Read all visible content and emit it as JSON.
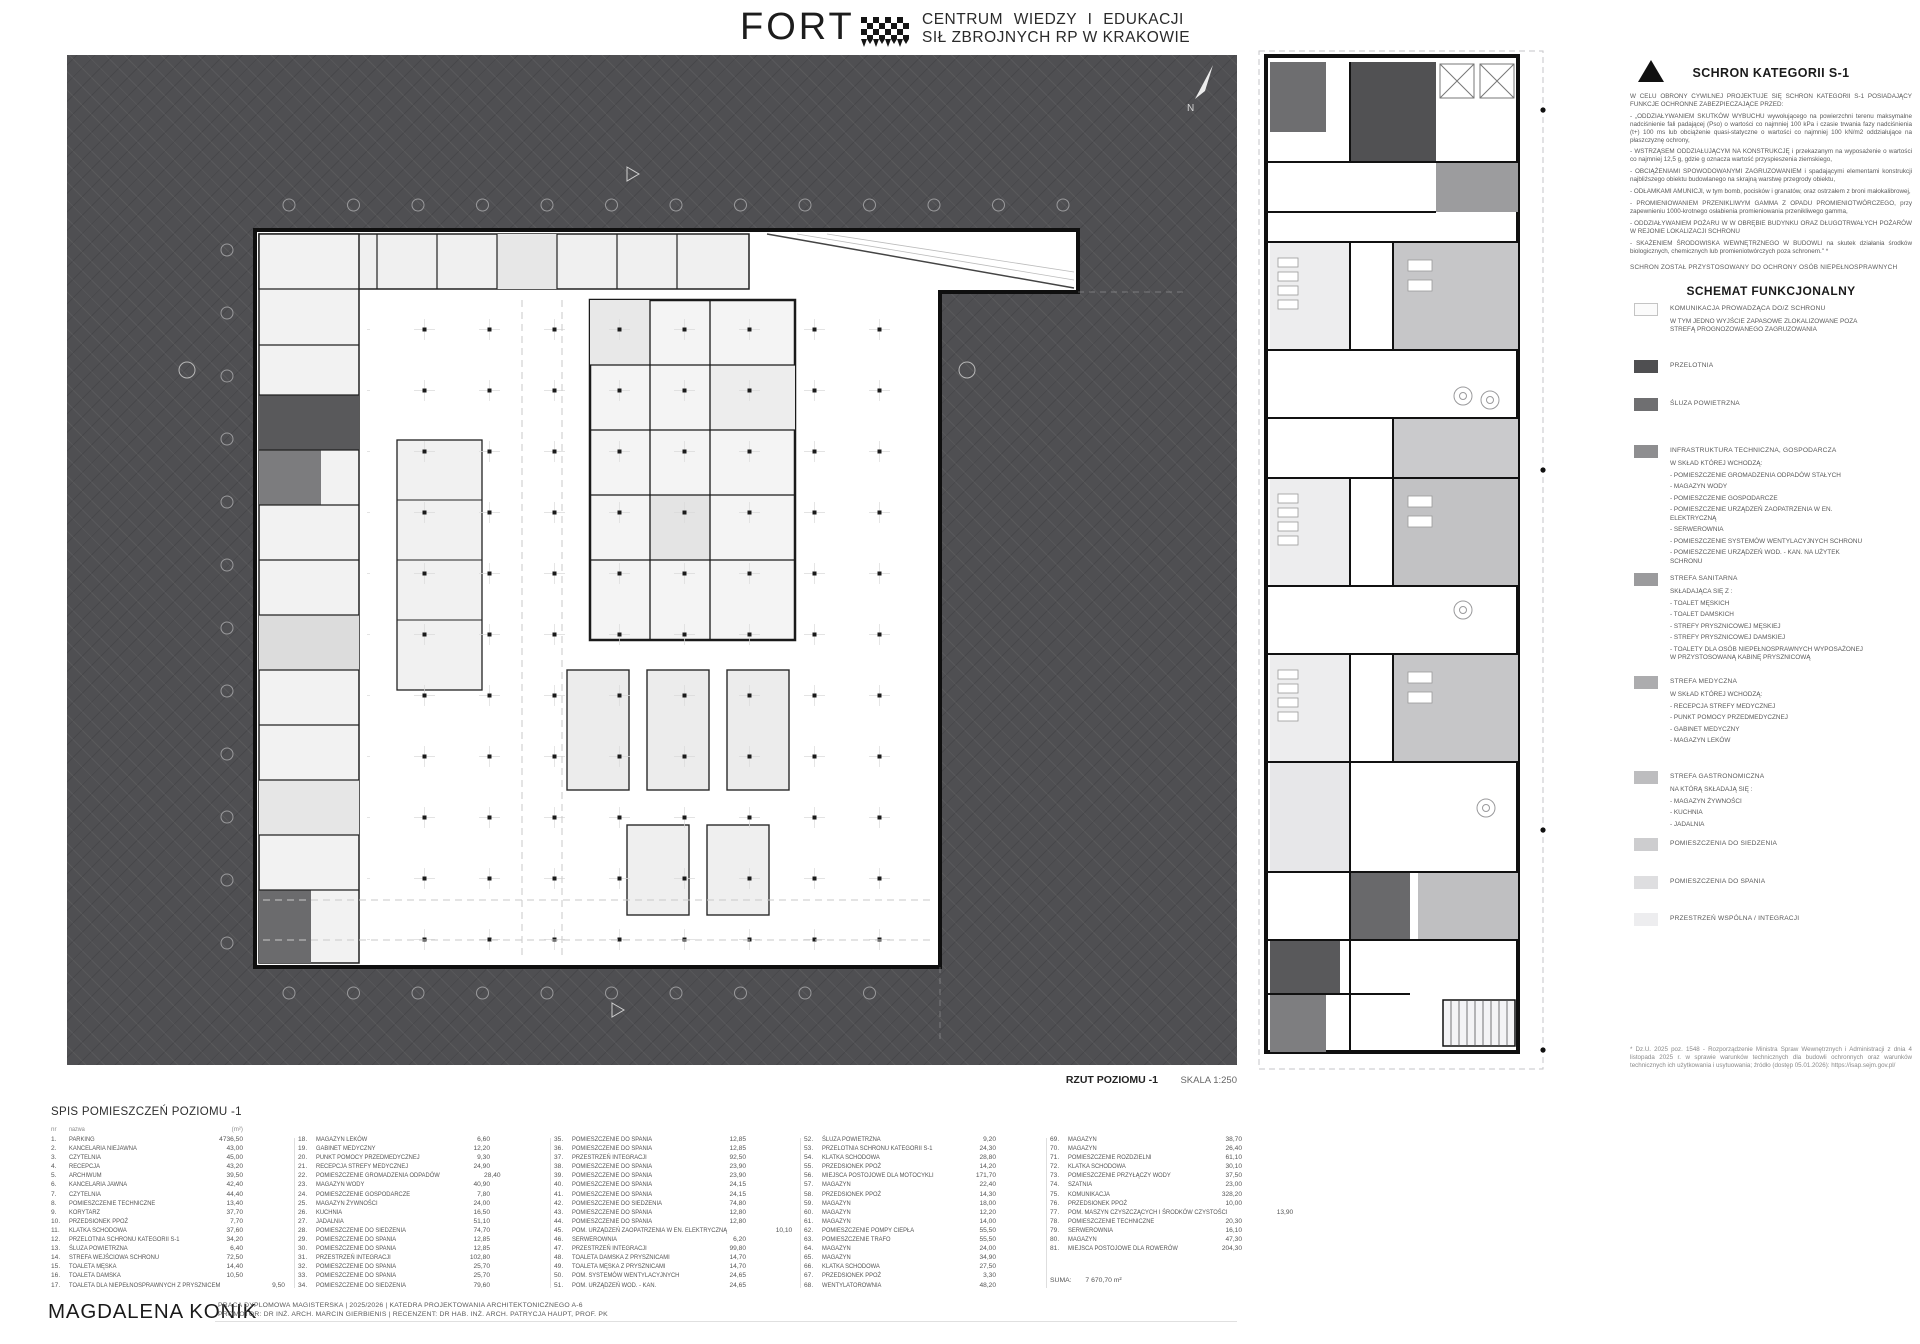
{
  "header": {
    "logo": "FORT",
    "title_line1": "CENTRUM  WIEDZY  I  EDUKACJI",
    "title_line2": "SIŁ ZBROJNYCH RP W KRAKOWIE"
  },
  "main_plan": {
    "caption_title": "RZUT POZIOMU -1",
    "caption_scale": "SKALA 1:250",
    "north_label": "N"
  },
  "right_panel": {
    "title": "SCHRON KATEGORII S-1",
    "intro": "W CELU OBRONY CYWILNEJ  PROJEKTUJE SIĘ SCHRON KATEGORII S-1 POSIADAJĄCY FUNKCJE OCHRONNE ZABEZPIECZAJĄCE PRZED:",
    "bullets": [
      "-  „ODDZIAŁYWANIEM SKUTKÓW WYBUCHU wywołującego na powierzchni terenu maksymalne nadciśnienie fali padającej (Pso) o wartości co najmniej 100 kPa i czasie trwania fazy nadciśnienia (t+) 100 ms lub obciążenie quasi-statyczne o wartości co najmniej 100 kN/m2 oddziałujące na płaszczyznę ochrony,",
      "-  WSTRZĄSEM ODDZIAŁUJĄCYM NA KONSTRUKCJĘ i przekazanym na wyposażenie o wartości co najmniej 12,5 g, gdzie g oznacza wartość przyspieszenia ziemskiego,",
      "-  OBCIĄŻENIAMI SPOWODOWANYMI ZAGRUZOWANIEM i spadającymi elementami konstrukcji najbliższego obiektu budowlanego na skrajną warstwę przegrody obiektu,",
      "-  ODŁAMKAMI AMUNICJI, w tym bomb, pocisków i granatów, oraz ostrzałem z broni małokalibrowej,",
      "-  PROMIENIOWANIEM PRZENIKLIWYM GAMMA Z OPADU PROMIENIOTWÓRCZEGO, przy zapewnieniu 1000-krotnego osłabienia promieniowania przenikliwego gamma,",
      "-  ODDZIAŁYWANIEM POŻARU W W OBRĘBIE BUDYNKU ORAZ DŁUGOTRWAŁYCH POŻARÓW W REJONIE LOKALIZACJI SCHRONU",
      "-  SKAŻENIEM ŚRODOWISKA WEWNĘTRZNEGO W BUDOWLI na skutek działania środków biologicznych, chemicznych lub promieniotwórczych poza schronem.\" *"
    ],
    "note": "SCHRON ZOSTAŁ PRZYSTOSOWANY DO OCHRONY OSÓB NIEPEŁNOSPRAWNYCH",
    "legend_title": "SCHEMAT FUNKCJONALNY",
    "legend": [
      {
        "color": "#fbfbfb",
        "border": "#c4c4c4",
        "label": "KOMUNIKACJA PROWADZĄCA DO/Z  SCHRONU",
        "sublines": [
          "W  TYM  JEDNO  WYJŚCIE  ZAPASOWE ZLOKALIZOWANE     POZA     STREFĄ PROGNOZOWANEGO ZAGRUZOWANIA"
        ]
      },
      {
        "color": "#4f4f51",
        "label": "PRZELOTNIA"
      },
      {
        "color": "#6f6f71",
        "label": "ŚLUZA POWIETRZNA"
      },
      {
        "color": "#8e8e90",
        "label": "INFRASTRUKTURA TECHNICZNA, GOSPODARCZA",
        "sublines": [
          "W SKŁAD KTÓREJ WCHODZĄ:",
          "- POMIESZCZENIE GROMADZENIA ODPADÓW STAŁYCH",
          "- MAGAZYN WODY",
          "- POMIESZCZENIE GOSPODARCZE",
          "- POMIESZCZENIE URZĄDZEŃ ZAOPATRZENIA W EN. ELEKTRYCZNĄ",
          "- SERWEROWNIA",
          "- POMIESZCZENIE SYSTEMÓW WENTYLACYJNYCH SCHRONU",
          "- POMIESZCZENIE URZĄDZEŃ  WOD. - KAN. NA UŻYTEK SCHRONU"
        ]
      },
      {
        "color": "#9b9b9d",
        "label": "STREFA SANITARNA",
        "sublines": [
          "SKŁADAJĄCA SIĘ Z :",
          "- TOALET MĘSKICH",
          "- TOALET DAMSKICH",
          "- STREFY PRYSZNICOWEJ MĘSKIEJ",
          "- STREFY PRYSZNICOWEJ DAMSKIEJ",
          "- TOALETY DLA OSÓB NIEPEŁNOSPRAWNYCH WYPOSAŻONEJ W PRZYSTOSOWANĄ KABINĘ PRYSZNICOWĄ"
        ]
      },
      {
        "color": "#acacae",
        "label": "STREFA MEDYCZNA",
        "sublines": [
          "W SKŁAD KTÓREJ WCHODZĄ:",
          "- RECEPCJA STREFY MEDYCZNEJ",
          "- PUNKT POMOCY PRZEDMEDYCZNEJ",
          "- GABINET MEDYCZNY",
          "- MAGAZYN LEKÓW"
        ]
      },
      {
        "color": "#bdbdbf",
        "label": "STREFA GASTRONOMICZNA",
        "sublines": [
          "NA KTÓRĄ SKŁADAJĄ SIĘ :",
          "- MAGAZYN ŻYWNOŚCI",
          "- KUCHNIA",
          "- JADALNIA"
        ]
      },
      {
        "color": "#cdcdcf",
        "label": "POMIESZCZENIA DO SIEDZENIA"
      },
      {
        "color": "#dedee0",
        "label": "POMIESZCZENIA DO SPANIA"
      },
      {
        "color": "#ededef",
        "label": "PRZESTRZEŃ WSPÓLNA / INTEGRACJI"
      }
    ],
    "footnote": "* Dz.U. 2025 poz. 1548 - Rozporządzenie Ministra Spraw Wewnętrznych i Administracji z dnia 4 listopada 2025 r. w sprawie warunków technicznych dla budowli ochronnych oraz warunków technicznych ich użytkowania i usytuowania; źródło (dostęp 05.01.2026): https://isap.sejm.gov.pl/"
  },
  "room_schedule": {
    "title": "SPIS POMIESZCZEŃ POZIOMU -1",
    "col_headers": {
      "nr": "nr",
      "name": "nazwa",
      "area": "(m²)"
    },
    "rooms": [
      [
        1,
        "PARKING",
        "4736,50"
      ],
      [
        2,
        "KANCELARIA NIEJAWNA",
        "43,00"
      ],
      [
        3,
        "CZYTELNIA",
        "45,00"
      ],
      [
        4,
        "RECEPCJA",
        "43,20"
      ],
      [
        5,
        "ARCHIWUM",
        "39,50"
      ],
      [
        6,
        "KANCELARIA JAWNA",
        "42,40"
      ],
      [
        7,
        "CZYTELNIA",
        "44,40"
      ],
      [
        8,
        "POMIESZCZENIE TECHNICZNE",
        "13,40"
      ],
      [
        9,
        "KORYTARZ",
        "37,70"
      ],
      [
        10,
        "PRZEDSIONEK PPOŻ",
        "7,70"
      ],
      [
        11,
        "KLATKA SCHODOWA",
        "37,60"
      ],
      [
        12,
        "PRZELOTNIA SCHRONU KATEGORII S-1",
        "34,20"
      ],
      [
        13,
        "ŚLUZA POWIETRZNA",
        "6,40"
      ],
      [
        14,
        "STREFA WEJŚCIOWA SCHRONU",
        "72,50"
      ],
      [
        15,
        "TOALETA MĘSKA",
        "14,40"
      ],
      [
        16,
        "TOALETA DAMSKA",
        "10,50"
      ],
      [
        17,
        "TOALETA DLA NIEPEŁNOSPRAWNYCH Z PRYSZNICEM",
        "9,50"
      ],
      [
        18,
        "MAGAZYN LEKÓW",
        "6,60"
      ],
      [
        19,
        "GABINET MEDYCZNY",
        "12,20"
      ],
      [
        20,
        "PUNKT POMOCY PRZEDMEDYCZNEJ",
        "9,30"
      ],
      [
        21,
        "RECEPCJA STREFY MEDYCZNEJ",
        "24,90"
      ],
      [
        22,
        "POMIESZCZENIE GROMADZENIA ODPADÓW",
        "28,40"
      ],
      [
        23,
        "MAGAZYN WODY",
        "40,90"
      ],
      [
        24,
        "POMIESZCZENIE GOSPODARCZE",
        "7,80"
      ],
      [
        25,
        "MAGAZYN ŻYWNOŚCI",
        "24,00"
      ],
      [
        26,
        "KUCHNIA",
        "16,50"
      ],
      [
        27,
        "JADALNIA",
        "51,10"
      ],
      [
        28,
        "POMIESZCZENIE DO SIEDZENIA",
        "74,70"
      ],
      [
        29,
        "POMIESZCZENIE DO SPANIA",
        "12,85"
      ],
      [
        30,
        "POMIESZCZENIE DO SPANIA",
        "12,85"
      ],
      [
        31,
        "PRZESTRZEŃ INTEGRACJI",
        "102,80"
      ],
      [
        32,
        "POMIESZCZENIE DO SPANIA",
        "25,70"
      ],
      [
        33,
        "POMIESZCZENIE DO SPANIA",
        "25,70"
      ],
      [
        34,
        "POMIESZCZENIE DO SIEDZENIA",
        "79,60"
      ],
      [
        35,
        "POMIESZCZENIE DO SPANIA",
        "12,85"
      ],
      [
        36,
        "POMIESZCZENIE DO SPANIA",
        "12,85"
      ],
      [
        37,
        "PRZESTRZEŃ INTEGRACJI",
        "92,50"
      ],
      [
        38,
        "POMIESZCZENIE DO SPANIA",
        "23,90"
      ],
      [
        39,
        "POMIESZCZENIE DO SPANIA",
        "23,90"
      ],
      [
        40,
        "POMIESZCZENIE DO SPANIA",
        "24,15"
      ],
      [
        41,
        "POMIESZCZENIE DO SPANIA",
        "24,15"
      ],
      [
        42,
        "POMIESZCZENIE DO SIEDZENIA",
        "74,80"
      ],
      [
        43,
        "POMIESZCZENIE DO SPANIA",
        "12,80"
      ],
      [
        44,
        "POMIESZCZENIE DO SPANIA",
        "12,80"
      ],
      [
        45,
        "POM. URZĄDZEŃ ZAOPATRZENIA W EN. ELEKTRYCZNĄ",
        "10,10"
      ],
      [
        46,
        "SERWEROWNIA",
        "6,20"
      ],
      [
        47,
        "PRZESTRZEŃ INTEGRACJI",
        "99,80"
      ],
      [
        48,
        "TOALETA DAMSKA Z PRYSZNICAMI",
        "14,70"
      ],
      [
        49,
        "TOALETA MĘSKA Z PRYSZNICAMI",
        "14,70"
      ],
      [
        50,
        "POM. SYSTEMÓW WENTYLACYJNYCH",
        "24,65"
      ],
      [
        51,
        "POM. URZĄDZEŃ WOD. - KAN.",
        "24,65"
      ],
      [
        52,
        "ŚLUZA POWIETRZNA",
        "9,20"
      ],
      [
        53,
        "PRZELOTNIA SCHRONU KATEGORII S-1",
        "24,30"
      ],
      [
        54,
        "KLATKA SCHODOWA",
        "28,80"
      ],
      [
        55,
        "PRZEDSIONEK PPOŻ",
        "14,20"
      ],
      [
        56,
        "MIEJSCA POSTOJOWE DLA MOTOCYKLI",
        "171,70"
      ],
      [
        57,
        "MAGAZYN",
        "22,40"
      ],
      [
        58,
        "PRZEDSIONEK PPOŻ",
        "14,30"
      ],
      [
        59,
        "MAGAZYN",
        "18,00"
      ],
      [
        60,
        "MAGAZYN",
        "12,20"
      ],
      [
        61,
        "MAGAZYN",
        "14,00"
      ],
      [
        62,
        "POMIESZCZENIE POMPY CIEPŁA",
        "55,50"
      ],
      [
        63,
        "POMIESZCZENIE TRAFO",
        "55,50"
      ],
      [
        64,
        "MAGAZYN",
        "24,00"
      ],
      [
        65,
        "MAGAZYN",
        "34,90"
      ],
      [
        66,
        "KLATKA SCHODOWA",
        "27,50"
      ],
      [
        67,
        "PRZEDSIONEK PPOŻ",
        "3,30"
      ],
      [
        68,
        "WENTYLATOROWNIA",
        "48,20"
      ],
      [
        69,
        "MAGAZYN",
        "38,70"
      ],
      [
        70,
        "MAGAZYN",
        "26,40"
      ],
      [
        71,
        "POMIESZCZENIE ROZDZIELNI",
        "61,10"
      ],
      [
        72,
        "KLATKA SCHODOWA",
        "30,10"
      ],
      [
        73,
        "POMIESZCZENIE PRZYŁĄCZY WODY",
        "37,50"
      ],
      [
        74,
        "SZATNIA",
        "23,00"
      ],
      [
        75,
        "KOMUNIKACJA",
        "328,20"
      ],
      [
        76,
        "PRZEDSIONEK PPOŻ",
        "10,00"
      ],
      [
        77,
        "POM. MASZYN CZYSZCZĄCYCH I ŚRODKÓW CZYSTOŚCI",
        "13,90"
      ],
      [
        78,
        "POMIESZCZENIE TECHNICZNE",
        "20,30"
      ],
      [
        79,
        "SERWEROWNIA",
        "16,10"
      ],
      [
        80,
        "MAGAZYN",
        "47,30"
      ],
      [
        81,
        "MIEJSCA POSTOJOWE DLA ROWERÓW",
        "204,30"
      ]
    ],
    "suma_label": "SUMA:",
    "suma_value": "7 670,70 m²"
  },
  "footer": {
    "author": "MAGDALENA KONIK",
    "line1": "PRACA  DYPLOMOWA  MAGISTERSKA   |   2025/2026   |   KATEDRA  PROJEKTOWANIA  ARCHITEKTONICZNEGO  A-6",
    "line2": "PROMOTOR: DR INŻ. ARCH. MARCIN GIERBIENIS | RECENZENT: DR HAB. INŻ. ARCH. PATRYCJA HAUPT, PROF. PK"
  }
}
